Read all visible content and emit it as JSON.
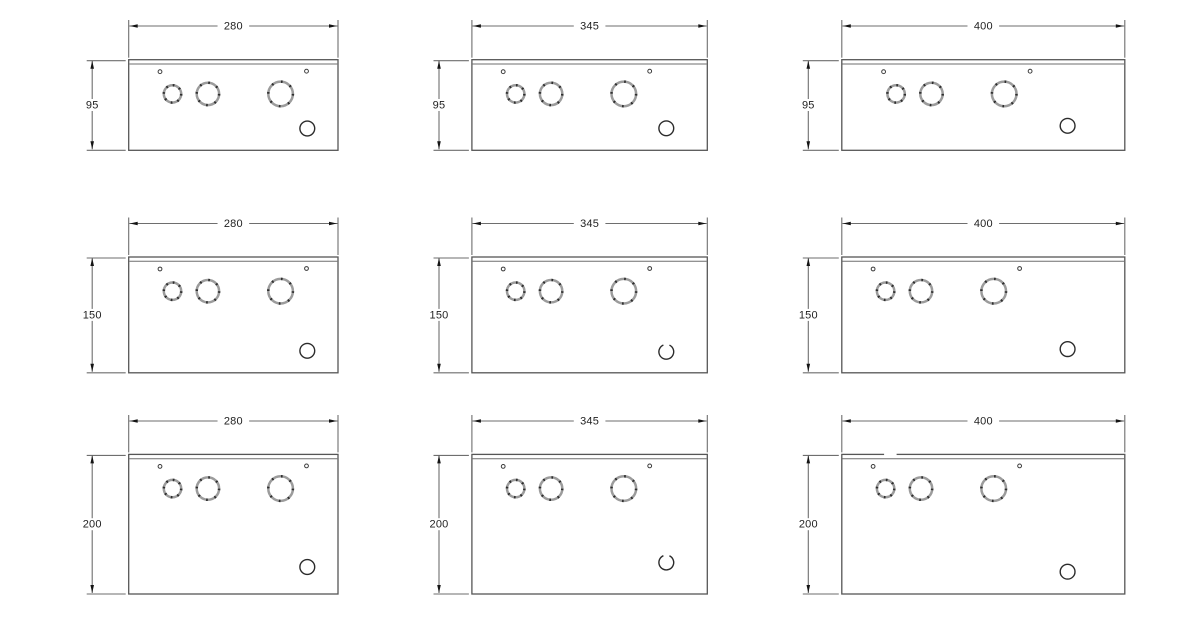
{
  "diagram": {
    "column_width_labels": [
      "280",
      "345",
      "400"
    ],
    "row_height_labels": [
      "95",
      "150",
      "200"
    ],
    "panels": [
      {
        "id": "row1-col1",
        "width_label": "280",
        "height_label": "95"
      },
      {
        "id": "row1-col2",
        "width_label": "345",
        "height_label": "95"
      },
      {
        "id": "row1-col3",
        "width_label": "400",
        "height_label": "95"
      },
      {
        "id": "row2-col1",
        "width_label": "280",
        "height_label": "150"
      },
      {
        "id": "row2-col2",
        "width_label": "345",
        "height_label": "150"
      },
      {
        "id": "row2-col3",
        "width_label": "400",
        "height_label": "150"
      },
      {
        "id": "row3-col1",
        "width_label": "280",
        "height_label": "200"
      },
      {
        "id": "row3-col2",
        "width_label": "345",
        "height_label": "200"
      },
      {
        "id": "row3-col3",
        "width_label": "400",
        "height_label": "200"
      }
    ],
    "holes_per_panel": {
      "screw_holes": 2,
      "knockout_holes": 3,
      "cable_entry_holes": 1
    }
  },
  "colors": {
    "background": "#ffffff",
    "line": "#565656",
    "dim_line": "#6e6e6e",
    "text": "#1f1f1f",
    "arrow": "#141414",
    "knockout_ring": "#9c9c9c",
    "knockout_dash": "#2d2d2d",
    "hole_stroke": "#2b2b2b"
  }
}
